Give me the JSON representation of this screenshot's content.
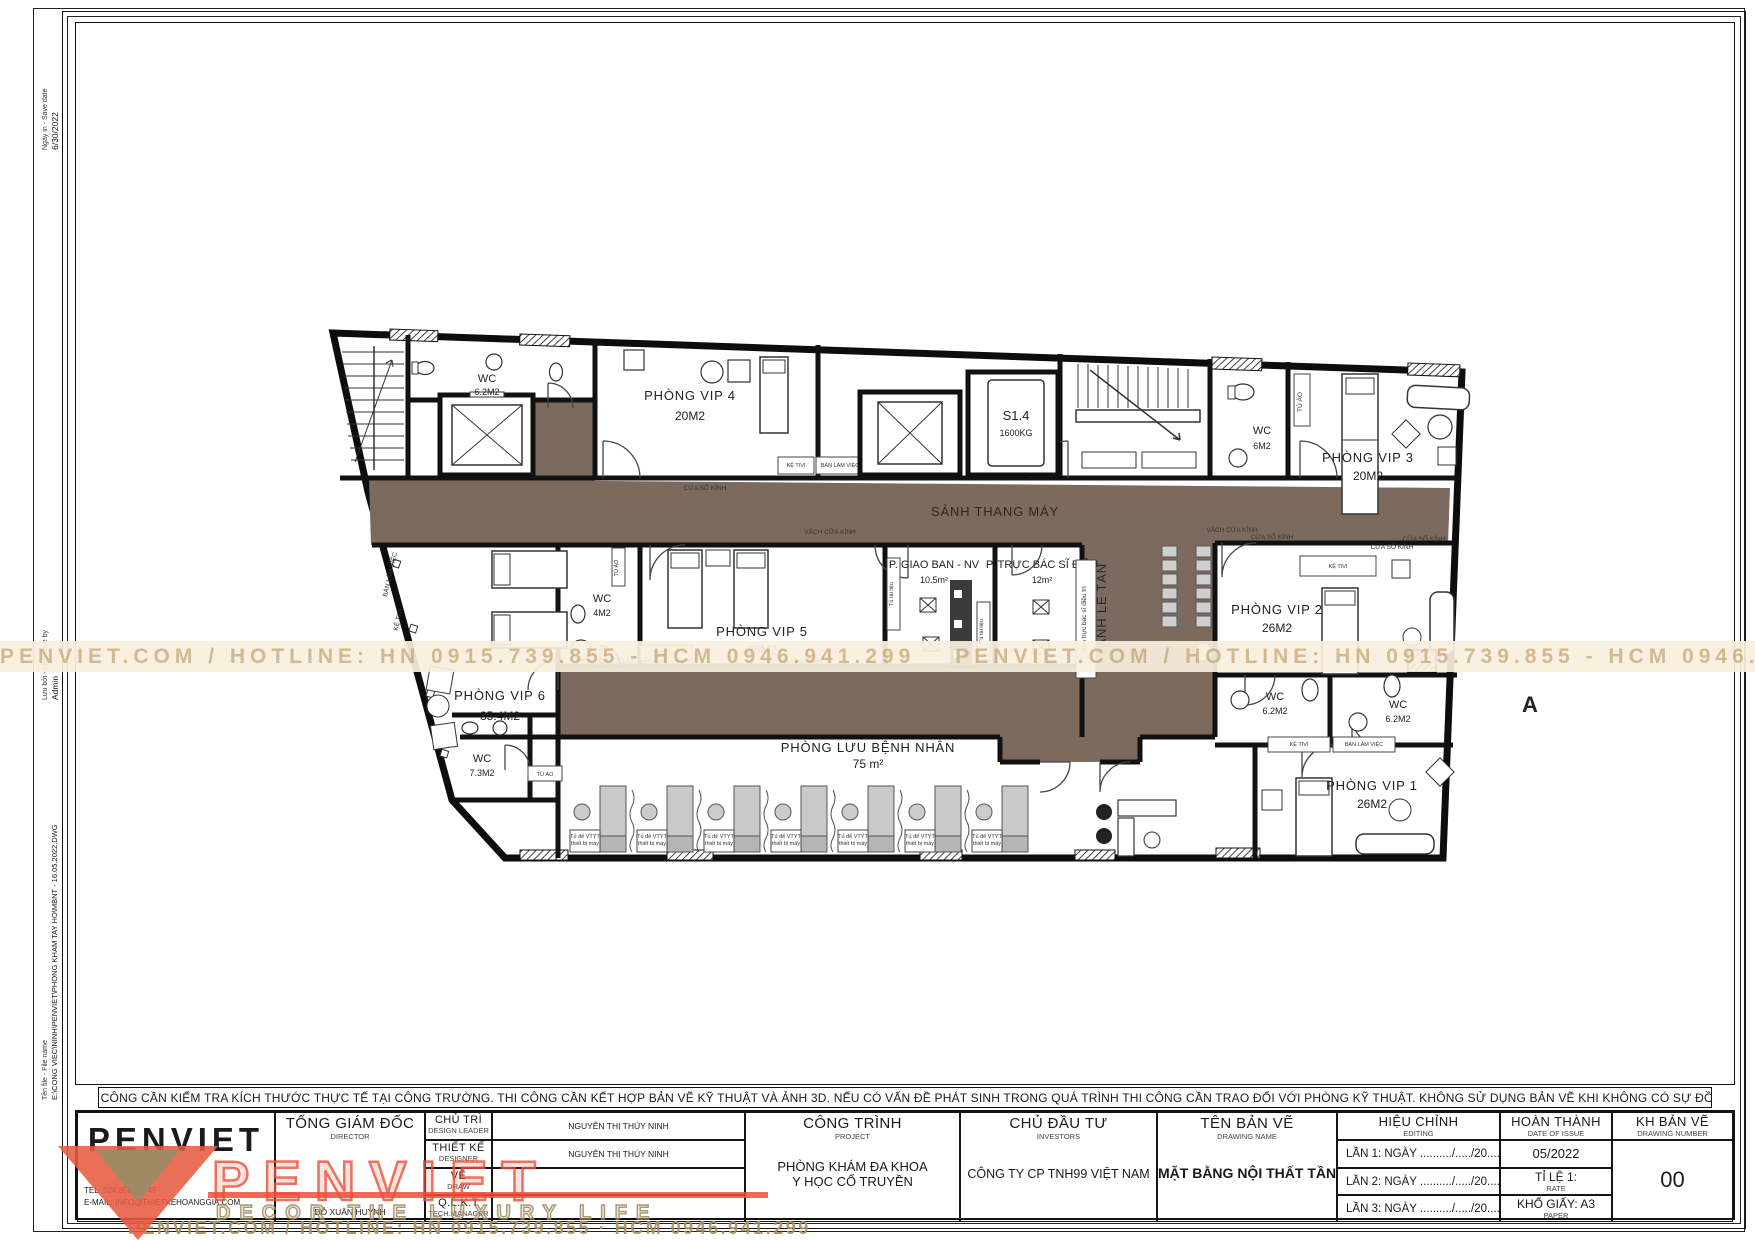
{
  "meta": {
    "print_label": "Ngày in - Save date",
    "print_value": "6/30/2022",
    "save_label": "Lưu bởi - Last save by",
    "save_value": "Admin",
    "file_label": "Tên file - File name",
    "file_value": "E:\\CONG VIEC\\NINH\\PENVIET\\PHONG KHAM TAY HO\\MBNT - 16.05.2022.DWG"
  },
  "watermark": {
    "band_text": "PENVIET.COM / HOTLINE: HN 0915.739.855 - HCM 0946.941.299",
    "footer_text": "PENVIET.COM / HOTLINE: HN 0915.739.855 · HCM 0946.941.299",
    "logo_text": "PENVIET",
    "logo_tagline": "DECOR THE LUXURY LIFE",
    "accent_red": "#e85a41",
    "tan": "#a78e5e"
  },
  "note": {
    "text": "GHI CHÚ: - TRƯỚC KHI THI CÔNG CẦN KIỂM TRA KÍCH THƯỚC THỰC TẾ TẠI CÔNG TRƯỜNG.  THI CÔNG CẦN KẾT HỢP BẢN VẼ KỸ THUẬT VÀ ẢNH 3D. NẾU CÓ VẤN ĐỀ PHÁT SINH TRONG QUÁ TRÌNH THI CÔNG CẦN TRAO ĐỔI VỚI PHÒNG KỸ THUẬT. KHÔNG SỬ DỤNG BẢN VẼ KHI KHÔNG CÓ SỰ ĐỒNG Ý CỦA ĐƠN VỊ TƯ VẤN."
  },
  "plan": {
    "corridor_color": "#7b6a5d",
    "labels": {
      "sanh_thang_may": "SẢNH THANG MÁY",
      "sanh_le_tan": "SẢNH LỄ TÂN",
      "ban_truc": "Bàn trực bác sĩ điều trị",
      "tu_tai_lieu": "Tủ tài liệu",
      "ke_tivi": "KỆ TIVI",
      "ban_lam_viec": "BÀN LÀM VIỆC",
      "cua_so_kinh": "CỬA SỔ KÍNH",
      "vach_cua_kinh": "VÁCH CỬA KÍNH",
      "tu_ao": "TỦ ÁO",
      "bed_cab_1": "Tủ để VTYT",
      "bed_cab_2": "thiết bị máy",
      "section_a": "A",
      "s14": "S1.4",
      "s14_load": "1600KG"
    },
    "rooms": {
      "vip1": {
        "name": "PHÒNG VIP 1",
        "area": "26M2"
      },
      "vip2": {
        "name": "PHÒNG VIP 2",
        "area": "26M2"
      },
      "vip3": {
        "name": "PHÒNG VIP 3",
        "area": "20M2"
      },
      "vip4": {
        "name": "PHÒNG VIP 4",
        "area": "20M2"
      },
      "vip5": {
        "name": "PHÒNG VIP 5",
        "area": "28M2"
      },
      "vip6": {
        "name": "PHÒNG VIP 6",
        "area": "35.4M2"
      },
      "wc_top": {
        "name": "WC",
        "area": "6.2M2"
      },
      "wc_6": {
        "name": "WC",
        "area": "6M2"
      },
      "wc_mid": {
        "name": "WC",
        "area": "4M2"
      },
      "wc_a": {
        "name": "WC",
        "area": "6.2M2"
      },
      "wc_b": {
        "name": "WC",
        "area": "6.2M2"
      },
      "wc_73": {
        "name": "WC",
        "area": "7.3M2"
      },
      "giao_ban": {
        "name": "P. GIAO BAN - NV",
        "area": "10.5m²"
      },
      "truc_bs": {
        "name": "P. TRỰC BÁC SĨ ĐIỀU",
        "area": "12m²"
      },
      "luu_benh_nhan": {
        "name": "PHÒNG LƯU BỆNH NHÂN",
        "area": "75 m²"
      }
    }
  },
  "title_block": {
    "logo": "PENVIET",
    "tel_label": "TEL:",
    "tel": "024.85875.745",
    "email_label": "E-MAIL:",
    "email": "INFO@THIETKEHOANGGIA.COM",
    "director": {
      "vi": "TỔNG GIÁM ĐỐC",
      "en": "DIRECTOR",
      "name": "ĐỖ XUÂN HUỲNH"
    },
    "roles": [
      {
        "vi": "CHỦ TRÌ",
        "en": "DESIGN LEADER",
        "name": "NGUYỄN THỊ THÚY NINH"
      },
      {
        "vi": "THIẾT KẾ",
        "en": "DESIGNER",
        "name": "NGUYỄN THỊ THÚY NINH"
      },
      {
        "vi": "VẼ",
        "en": "DRAW",
        "name": ""
      },
      {
        "vi": "Q.L.K.T",
        "en": "TECH.MANAGER",
        "name": ""
      }
    ],
    "project": {
      "vi": "CÔNG TRÌNH",
      "en": "PROJECT",
      "line1": "PHÒNG KHÁM ĐA KHOA",
      "line2": "Y HỌC CỔ TRUYỀN"
    },
    "investor": {
      "vi": "CHỦ ĐẦU TƯ",
      "en": "INVESTORS",
      "value": "CÔNG TY CP TNH99 VIỆT NAM"
    },
    "drawing_name": {
      "vi": "TÊN BẢN VẼ",
      "en": "DRAWING NAME",
      "value": "MẶT BẰNG NỘI THẤT TẦNG 4"
    },
    "editing": {
      "vi": "HIỆU CHỈNH",
      "en": "EDITING",
      "rows": [
        "LẦN 1: NGÀY  ........../...../20.....",
        "LẦN 2: NGÀY  ........../...../20.....",
        "LẦN 3: NGÀY ........../...../20....."
      ]
    },
    "completion": {
      "vi": "HOÀN THÀNH",
      "en": "DATE OF ISSUE",
      "date": "05/2022",
      "scale_vi": "TỈ LỆ 1:",
      "scale_en": "RATE",
      "paper_vi": "KHỔ GIẤY: A3",
      "paper_en": "PAPER"
    },
    "number": {
      "vi": "KH BẢN VẼ",
      "en": "DRAWING NUMBER",
      "value": "00"
    }
  }
}
